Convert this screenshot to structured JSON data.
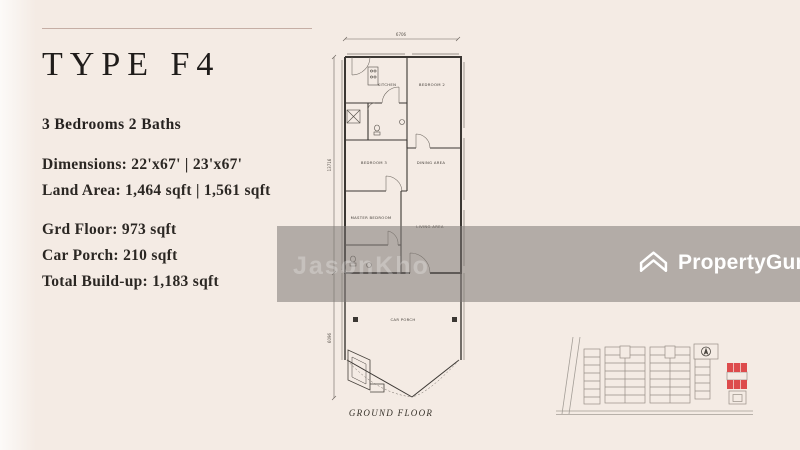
{
  "panel": {
    "title": "TYPE F4",
    "subtitle": "3 Bedrooms 2 Baths",
    "dimensions": "Dimensions: 22'x67' | 23'x67'",
    "land_area": "Land Area: 1,464 sqft | 1,561 sqft",
    "grd_floor": "Grd Floor: 973 sqft",
    "car_porch": "Car Porch: 210 sqft",
    "total_buildup": "Total Build-up: 1,183 sqft"
  },
  "floor_plan": {
    "caption": "GROUND FLOOR",
    "dim_width": "6706",
    "dim_depth_main": "13716",
    "dim_depth_porch": "6096",
    "rooms": {
      "kitchen": "KITCHEN",
      "bedroom2": "BEDROOM 2",
      "bedroom3": "BEDROOM 3",
      "dining": "DINING AREA",
      "master": "MASTER BEDROOM",
      "living": "LIVING AREA",
      "car_porch": "CAR PORCH"
    }
  },
  "watermark": "JasonKho",
  "brand": {
    "name": "PropertyGuru"
  },
  "colors": {
    "background": "#f4ebe4",
    "band": "rgba(125,121,117,0.55)",
    "accent_red": "#dd4b4c",
    "text": "#2b2723",
    "logo_white": "#ffffff"
  }
}
